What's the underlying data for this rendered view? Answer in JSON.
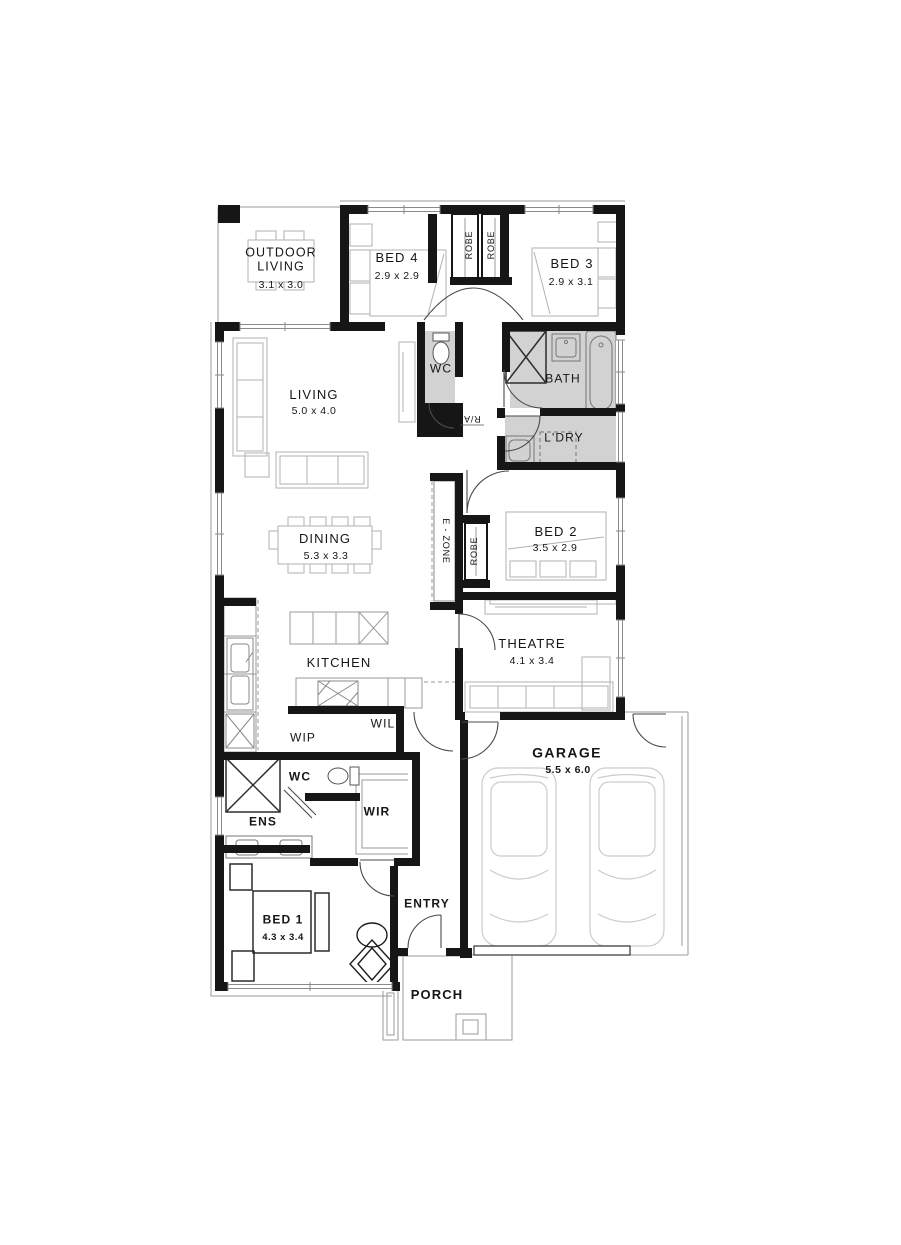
{
  "plan": {
    "rooms": [
      {
        "name": "OUTDOOR LIVING",
        "dims": "3.1 x 3.0"
      },
      {
        "name": "BED 4",
        "dims": "2.9 x 2.9"
      },
      {
        "name": "BED 3",
        "dims": "2.9 x 3.1"
      },
      {
        "name": "WC"
      },
      {
        "name": "BATH"
      },
      {
        "name": "L'DRY"
      },
      {
        "name": "LIVING",
        "dims": "5.0 x 4.0"
      },
      {
        "name": "DINING",
        "dims": "5.3 x 3.3"
      },
      {
        "name": "BED 2",
        "dims": "3.5 x 2.9"
      },
      {
        "name": "THEATRE",
        "dims": "4.1 x 3.4"
      },
      {
        "name": "KITCHEN"
      },
      {
        "name": "WIP"
      },
      {
        "name": "WIL"
      },
      {
        "name": "WC"
      },
      {
        "name": "ENS"
      },
      {
        "name": "WIR"
      },
      {
        "name": "BED 1",
        "dims": "4.3 x 3.4"
      },
      {
        "name": "ENTRY"
      },
      {
        "name": "PORCH"
      },
      {
        "name": "GARAGE",
        "dims": "5.5 x 6.0"
      }
    ],
    "fixtures": [
      {
        "label": "ROBE"
      },
      {
        "label": "ROBE"
      },
      {
        "label": "ROBE"
      },
      {
        "label": "E - ZONE"
      },
      {
        "label": "R/A"
      }
    ],
    "colors": {
      "wall": "#161616",
      "wet_area": "#d2d2d2",
      "furniture": "#b2b2b2",
      "background": "#ffffff"
    }
  }
}
